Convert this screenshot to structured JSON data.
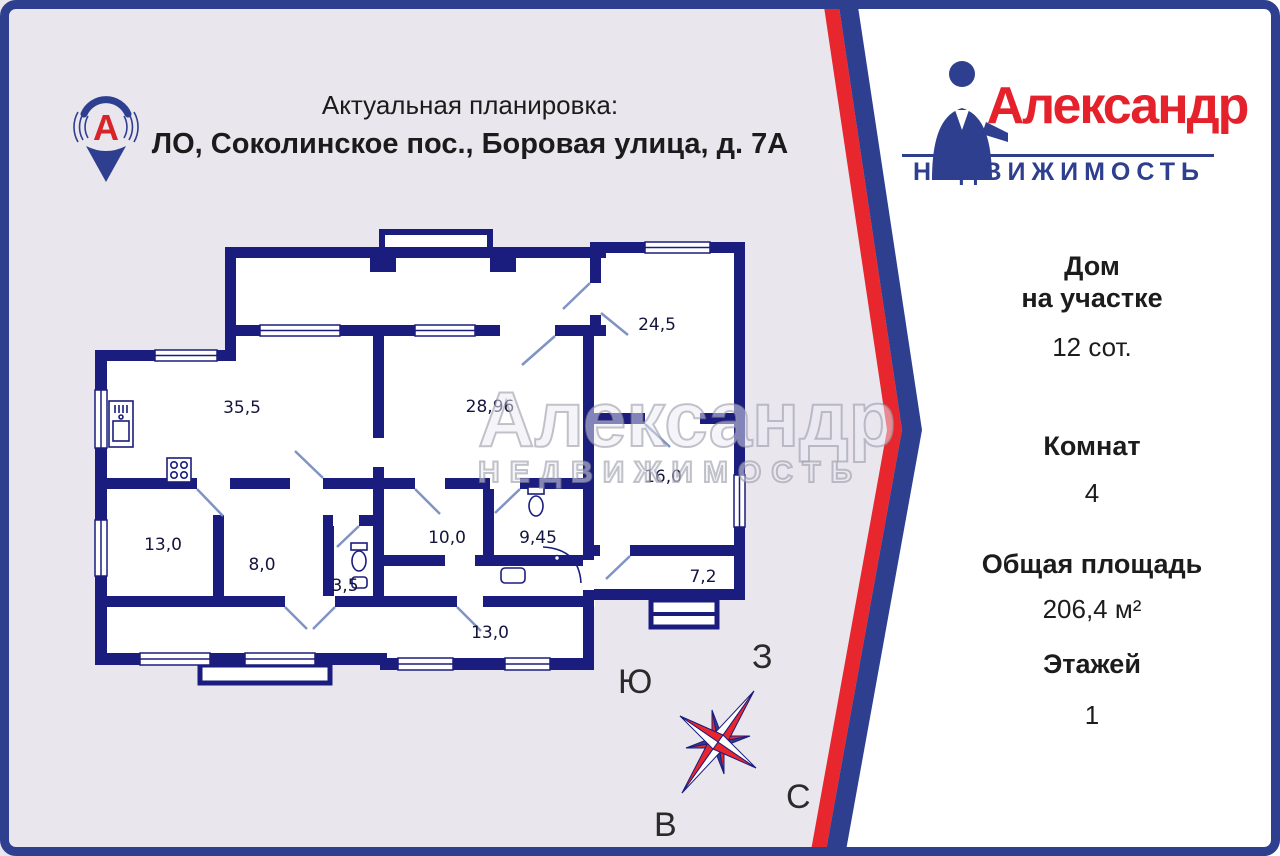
{
  "header": {
    "subtitle": "Актуальная планировка:",
    "address": "ЛО, Соколинское пос., Боровая улица, д. 7А"
  },
  "brand": {
    "pin_letter": "А",
    "name": "Александр",
    "tagline": "НЕДВИЖИМОСТЬ",
    "colors": {
      "brand_red": "#e5212b",
      "brand_blue": "#2e3f8f",
      "wall_navy": "#1b1d7e",
      "background_lavender": "#e9e6ee",
      "panel_white": "#ffffff"
    }
  },
  "watermark": {
    "line1": "Александр",
    "line2": "НЕДВИЖИМОСТЬ"
  },
  "info_panel": {
    "items": [
      {
        "label": "Дом\nна участке",
        "value": "12 сот."
      },
      {
        "label": "Комнат",
        "value": "4"
      },
      {
        "label": "Общая площадь",
        "value": "206,4 м²"
      },
      {
        "label": "Этажей",
        "value": "1"
      }
    ]
  },
  "floor_plan": {
    "rooms": [
      {
        "name": "room-35-5",
        "area_label": "35,5"
      },
      {
        "name": "room-28-96",
        "area_label": "28,96"
      },
      {
        "name": "room-24-5",
        "area_label": "24,5"
      },
      {
        "name": "room-16-0",
        "area_label": "16,0"
      },
      {
        "name": "room-13-0-left",
        "area_label": "13,0"
      },
      {
        "name": "room-8-0",
        "area_label": "8,0"
      },
      {
        "name": "wc-3-5",
        "area_label": "3,5"
      },
      {
        "name": "room-10-0",
        "area_label": "10,0"
      },
      {
        "name": "bathroom-9-45",
        "area_label": "9,45"
      },
      {
        "name": "hall-7-2",
        "area_label": "7,2"
      },
      {
        "name": "corridor-13-0",
        "area_label": "13,0"
      }
    ]
  },
  "compass": {
    "south": "Ю",
    "west": "З",
    "north": "С",
    "east": "В"
  }
}
